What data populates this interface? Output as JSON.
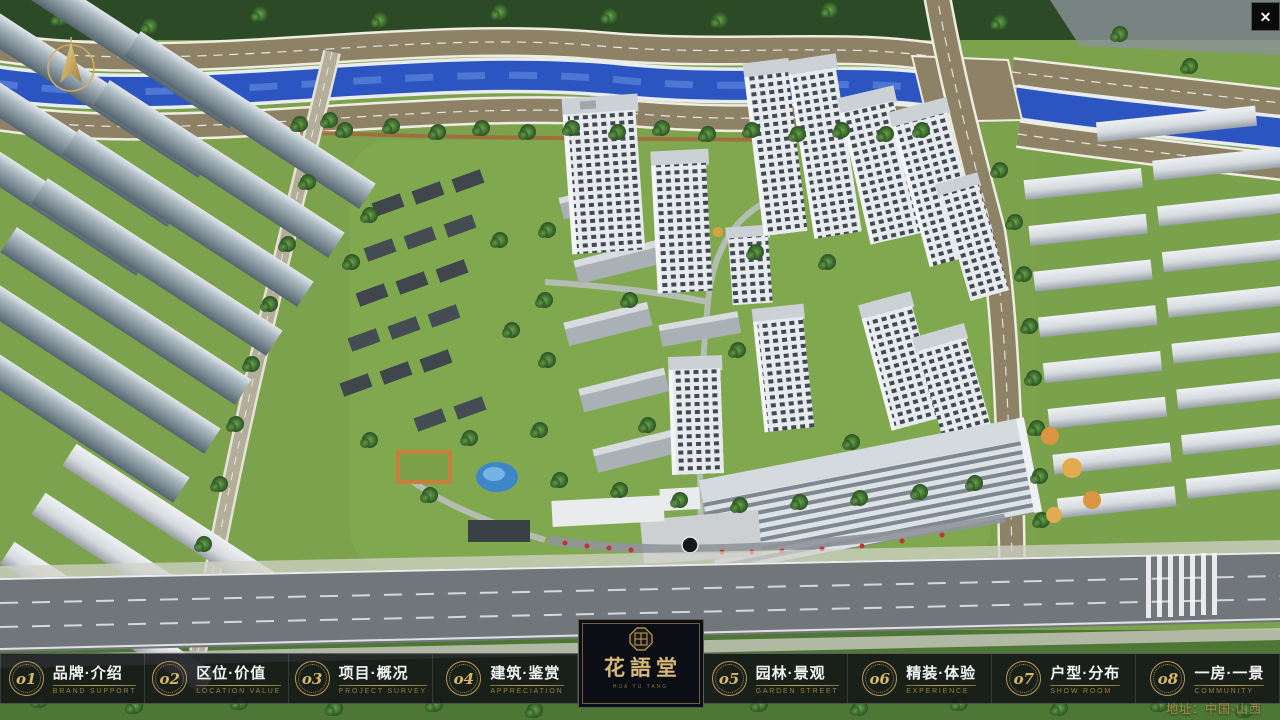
{
  "window": {
    "close_glyph": "✕"
  },
  "navbar": {
    "items": [
      {
        "num": "o1",
        "zh": "品牌·介绍",
        "en": "BRAND SUPPORT"
      },
      {
        "num": "o2",
        "zh": "区位·价值",
        "en": "LOCATION VALUE"
      },
      {
        "num": "o3",
        "zh": "项目·概况",
        "en": "PROJECT SURVEY"
      },
      {
        "num": "o4",
        "zh": "建筑·鉴赏",
        "en": "APPRECIATION"
      },
      {
        "num": "o5",
        "zh": "园林·景观",
        "en": "GARDEN STREET"
      },
      {
        "num": "o6",
        "zh": "精装·体验",
        "en": "EXPERIENCE"
      },
      {
        "num": "o7",
        "zh": "户型·分布",
        "en": "SHOW ROOM"
      },
      {
        "num": "o8",
        "zh": "一房·一景",
        "en": "COMMUNITY"
      }
    ]
  },
  "logo": {
    "title": "花語堂",
    "tagline": "HUA YU TANG"
  },
  "footer": {
    "address": "地址：中国·山西"
  },
  "colors": {
    "gold": "#c9a45c",
    "navbar_bg": "#14161a",
    "river_blue": "#2d55c2",
    "grass_green": "#7ca24d"
  }
}
